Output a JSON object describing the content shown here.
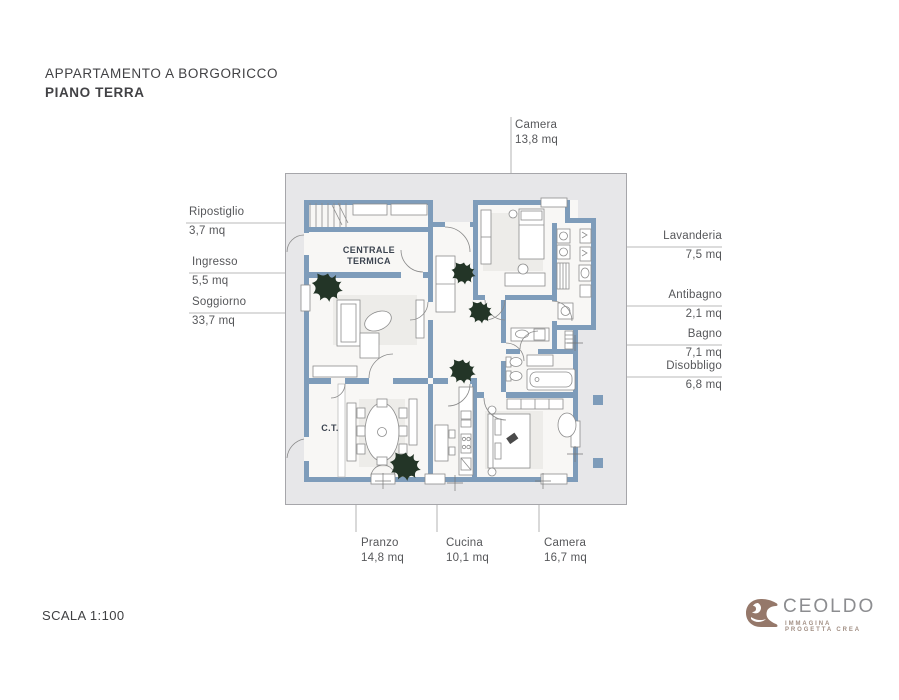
{
  "title": {
    "line1": "APPARTAMENTO A BORGORICCO",
    "line2": "PIANO TERRA"
  },
  "scale_label": "SCALA 1:100",
  "plan": {
    "inner_labels": {
      "centrale_termica": "CENTRALE TERMICA",
      "ct": "C.T."
    },
    "rooms": [
      {
        "name": "Camera",
        "area": "13,8 mq"
      },
      {
        "name": "Ripostiglio",
        "area": "3,7 mq"
      },
      {
        "name": "Ingresso",
        "area": "5,5 mq"
      },
      {
        "name": "Soggiorno",
        "area": "33,7 mq"
      },
      {
        "name": "Lavanderia",
        "area": "7,5 mq"
      },
      {
        "name": "Antibagno",
        "area": "2,1 mq"
      },
      {
        "name": "Bagno",
        "area": "7,1 mq"
      },
      {
        "name": "Disobbligo",
        "area": "6,8 mq"
      },
      {
        "name": "Pranzo",
        "area": "14,8 mq"
      },
      {
        "name": "Cucina",
        "area": "10,1 mq"
      },
      {
        "name": "Camera",
        "area": "16,7 mq"
      }
    ]
  },
  "logo": {
    "name": "CEOLDO",
    "tagline": "IMMAGINA PROGETTA CREA"
  },
  "colors": {
    "wall": "#7e9cba",
    "card_bg": "#e7e7e9",
    "room_bg": "#f8f7f5",
    "plant": "#233527",
    "logo_brown": "#95786a",
    "text_dark": "#424245",
    "label_gray": "#56575a"
  }
}
